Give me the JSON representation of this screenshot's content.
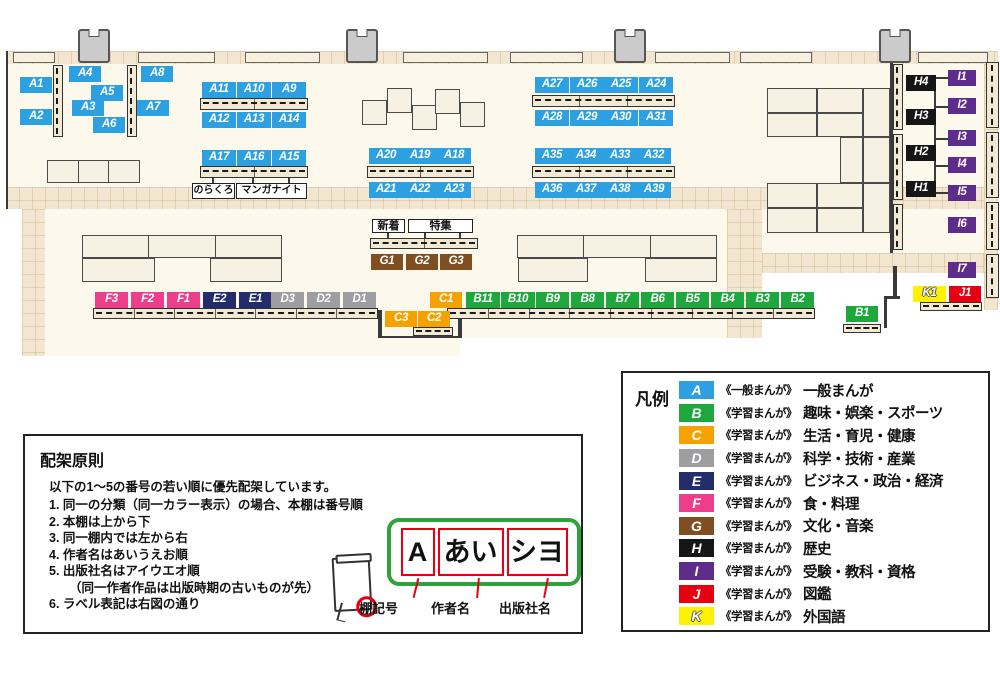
{
  "map": {
    "colors": {
      "A": "#2CA0E0",
      "B": "#1EA73C",
      "C": "#F5A200",
      "D": "#9E9EA0",
      "E": "#232D6B",
      "F": "#EE3D8B",
      "G": "#7F4F21",
      "H": "#161616",
      "I": "#5E2D8C",
      "J": "#E60012",
      "K": "#FFF100"
    },
    "floors": [
      [
        "tile",
        6,
        51,
        992,
        13
      ],
      [
        "cream",
        6,
        64,
        992,
        123
      ],
      [
        "tile",
        6,
        187,
        992,
        22
      ],
      [
        "tile",
        22,
        209,
        23,
        147
      ],
      [
        "cream",
        45,
        209,
        682,
        129
      ],
      [
        "tile",
        727,
        209,
        35,
        129
      ],
      [
        "cream",
        762,
        209,
        222,
        44
      ],
      [
        "tile",
        762,
        253,
        236,
        20
      ],
      [
        "cream",
        45,
        338,
        415,
        18
      ],
      [
        "tile",
        984,
        64,
        14,
        246
      ]
    ],
    "pillars": [
      [
        78,
        29
      ],
      [
        346,
        29
      ],
      [
        614,
        29
      ],
      [
        879,
        29
      ]
    ],
    "wall_shelves": [
      [
        13,
        42
      ],
      [
        138,
        77
      ],
      [
        245,
        75
      ],
      [
        403,
        85
      ],
      [
        510,
        73
      ],
      [
        655,
        75
      ],
      [
        740,
        72
      ],
      [
        918,
        70
      ]
    ],
    "walls": [
      [
        6,
        51,
        2,
        158
      ],
      [
        378,
        310,
        4,
        28
      ],
      [
        458,
        310,
        4,
        28
      ],
      [
        380,
        336,
        82,
        2
      ],
      [
        890,
        60,
        3,
        193
      ],
      [
        893,
        266,
        4,
        30
      ],
      [
        884,
        296,
        16,
        3
      ],
      [
        884,
        296,
        3,
        32
      ],
      [
        934,
        83,
        2,
        106
      ],
      [
        936,
        77,
        12,
        2
      ],
      [
        936,
        106,
        12,
        2
      ],
      [
        936,
        138,
        12,
        2
      ],
      [
        936,
        165,
        12,
        2
      ],
      [
        936,
        192,
        12,
        2
      ],
      [
        387,
        233,
        2,
        6
      ],
      [
        424,
        233,
        2,
        6
      ],
      [
        459,
        233,
        2,
        6
      ],
      [
        212,
        178,
        2,
        5
      ],
      [
        252,
        178,
        2,
        5
      ],
      [
        288,
        178,
        2,
        5
      ]
    ],
    "tables": [
      [
        47,
        160,
        93,
        23,
        4
      ],
      [
        362,
        100,
        25,
        25,
        1
      ],
      [
        387,
        88,
        25,
        25,
        1
      ],
      [
        412,
        105,
        25,
        25,
        1
      ],
      [
        435,
        89,
        25,
        25,
        1
      ],
      [
        460,
        102,
        25,
        25,
        1
      ],
      [
        82,
        235,
        200,
        23,
        4
      ],
      [
        82,
        258,
        73,
        24,
        1
      ],
      [
        210,
        258,
        72,
        24,
        1
      ],
      [
        517,
        235,
        200,
        23,
        4
      ],
      [
        518,
        258,
        70,
        24,
        1
      ],
      [
        645,
        258,
        72,
        24,
        1
      ],
      [
        767,
        88,
        50,
        25,
        1
      ],
      [
        817,
        88,
        46,
        25,
        1
      ],
      [
        863,
        88,
        27,
        49,
        1
      ],
      [
        767,
        113,
        50,
        24,
        1
      ],
      [
        817,
        113,
        46,
        24,
        1
      ],
      [
        840,
        137,
        23,
        46,
        1
      ],
      [
        863,
        137,
        27,
        46,
        1
      ],
      [
        767,
        183,
        50,
        25,
        1
      ],
      [
        817,
        183,
        46,
        25,
        1
      ],
      [
        863,
        183,
        27,
        50,
        1
      ],
      [
        767,
        208,
        50,
        25,
        1
      ],
      [
        817,
        208,
        46,
        25,
        1
      ]
    ],
    "shelves": [
      [
        53,
        65,
        10,
        72,
        2,
        1
      ],
      [
        127,
        65,
        10,
        72,
        2,
        1
      ],
      [
        200,
        98,
        108,
        12,
        3,
        0
      ],
      [
        200,
        166,
        108,
        12,
        3,
        0
      ],
      [
        367,
        166,
        107,
        12,
        3,
        0
      ],
      [
        532,
        95,
        143,
        12,
        4,
        0
      ],
      [
        532,
        166,
        143,
        12,
        4,
        0
      ],
      [
        370,
        238,
        108,
        11,
        3,
        0
      ],
      [
        93,
        308,
        285,
        11,
        8,
        0
      ],
      [
        447,
        308,
        368,
        11,
        10,
        0
      ],
      [
        413,
        327,
        40,
        9,
        1,
        0
      ],
      [
        843,
        324,
        38,
        9,
        1,
        0
      ],
      [
        920,
        302,
        62,
        9,
        2,
        0
      ],
      [
        986,
        62,
        13,
        66,
        2,
        1
      ],
      [
        986,
        132,
        13,
        66,
        2,
        1
      ],
      [
        986,
        202,
        13,
        48,
        1,
        1
      ],
      [
        986,
        254,
        13,
        44,
        1,
        1
      ],
      [
        893,
        64,
        10,
        66,
        2,
        1
      ],
      [
        893,
        134,
        10,
        66,
        2,
        1
      ],
      [
        893,
        204,
        10,
        46,
        1,
        1
      ]
    ],
    "signs": [
      {
        "id": "sign-norakuro",
        "text": "のらくろ",
        "x": 192,
        "y": 183,
        "w": 43,
        "h": 16,
        "fs": 10
      },
      {
        "id": "sign-manga-night",
        "text": "マンガナイト",
        "x": 236,
        "y": 183,
        "w": 71,
        "h": 16,
        "fs": 10
      },
      {
        "id": "sign-new-arrivals",
        "text": "新着",
        "x": 372,
        "y": 219,
        "w": 33,
        "h": 14,
        "fs": 11
      },
      {
        "id": "sign-special-feature",
        "text": "特集",
        "x": 408,
        "y": 219,
        "w": 65,
        "h": 14,
        "fs": 11
      }
    ],
    "labels": [
      [
        "A1",
        "A",
        20,
        77,
        32
      ],
      [
        "A2",
        "A",
        20,
        109,
        32
      ],
      [
        "A4",
        "A",
        69,
        66,
        32
      ],
      [
        "A5",
        "A",
        91,
        85,
        32
      ],
      [
        "A3",
        "A",
        72,
        100,
        32
      ],
      [
        "A6",
        "A",
        93,
        117,
        32
      ],
      [
        "A8",
        "A",
        141,
        66,
        32
      ],
      [
        "A7",
        "A",
        137,
        100,
        32
      ],
      [
        "A11",
        "A",
        202,
        82,
        34
      ],
      [
        "A10",
        "A",
        237,
        82,
        34
      ],
      [
        "A9",
        "A",
        272,
        82,
        34
      ],
      [
        "A12",
        "A",
        202,
        112,
        34
      ],
      [
        "A13",
        "A",
        237,
        112,
        34
      ],
      [
        "A14",
        "A",
        272,
        112,
        34
      ],
      [
        "A17",
        "A",
        202,
        150,
        34
      ],
      [
        "A16",
        "A",
        237,
        150,
        34
      ],
      [
        "A15",
        "A",
        272,
        150,
        34
      ],
      [
        "A27",
        "A",
        535,
        77,
        34
      ],
      [
        "A26",
        "A",
        570,
        77,
        34
      ],
      [
        "A25",
        "A",
        604,
        77,
        34
      ],
      [
        "A24",
        "A",
        639,
        77,
        34
      ],
      [
        "A28",
        "A",
        535,
        110,
        34
      ],
      [
        "A29",
        "A",
        570,
        110,
        34
      ],
      [
        "A30",
        "A",
        604,
        110,
        34
      ],
      [
        "A31",
        "A",
        639,
        110,
        34
      ],
      [
        "A20",
        "A",
        369,
        148,
        34
      ],
      [
        "A19",
        "A",
        403,
        148,
        34
      ],
      [
        "A18",
        "A",
        437,
        148,
        34
      ],
      [
        "A21",
        "A",
        369,
        182,
        34
      ],
      [
        "A22",
        "A",
        403,
        182,
        34
      ],
      [
        "A23",
        "A",
        437,
        182,
        34
      ],
      [
        "A35",
        "A",
        535,
        148,
        34
      ],
      [
        "A34",
        "A",
        569,
        148,
        34
      ],
      [
        "A33",
        "A",
        603,
        148,
        34
      ],
      [
        "A32",
        "A",
        637,
        148,
        34
      ],
      [
        "A36",
        "A",
        535,
        182,
        34
      ],
      [
        "A37",
        "A",
        569,
        182,
        34
      ],
      [
        "A38",
        "A",
        603,
        182,
        34
      ],
      [
        "A39",
        "A",
        637,
        182,
        34
      ],
      [
        "G1",
        "G",
        371,
        254,
        32
      ],
      [
        "G2",
        "G",
        406,
        254,
        32
      ],
      [
        "G3",
        "G",
        440,
        254,
        32
      ],
      [
        "F3",
        "F",
        95,
        292,
        33
      ],
      [
        "F2",
        "F",
        131,
        292,
        33
      ],
      [
        "F1",
        "F",
        167,
        292,
        33
      ],
      [
        "E2",
        "E",
        203,
        292,
        33
      ],
      [
        "E1",
        "E",
        239,
        292,
        33
      ],
      [
        "D3",
        "D",
        271,
        292,
        33
      ],
      [
        "D2",
        "D",
        307,
        292,
        33
      ],
      [
        "D1",
        "D",
        343,
        292,
        33
      ],
      [
        "C1",
        "C",
        430,
        292,
        32
      ],
      [
        "C3",
        "C",
        385,
        311,
        32
      ],
      [
        "C2",
        "C",
        418,
        311,
        32
      ],
      [
        "B11",
        "B",
        466,
        292,
        34
      ],
      [
        "B10",
        "B",
        501,
        292,
        34
      ],
      [
        "B9",
        "B",
        536,
        292,
        33
      ],
      [
        "B8",
        "B",
        571,
        292,
        33
      ],
      [
        "B7",
        "B",
        606,
        292,
        33
      ],
      [
        "B6",
        "B",
        641,
        292,
        33
      ],
      [
        "B5",
        "B",
        676,
        292,
        33
      ],
      [
        "B4",
        "B",
        711,
        292,
        33
      ],
      [
        "B3",
        "B",
        746,
        292,
        33
      ],
      [
        "B2",
        "B",
        781,
        292,
        33
      ],
      [
        "B1",
        "B",
        846,
        306,
        32
      ],
      [
        "K1",
        "K",
        913,
        286,
        33
      ],
      [
        "J1",
        "J",
        949,
        286,
        32
      ],
      [
        "H4",
        "H",
        906,
        75,
        30
      ],
      [
        "H3",
        "H",
        906,
        109,
        30
      ],
      [
        "H2",
        "H",
        906,
        145,
        30
      ],
      [
        "H1",
        "H",
        906,
        181,
        30
      ],
      [
        "I1",
        "I",
        948,
        70,
        28
      ],
      [
        "I2",
        "I",
        948,
        98,
        28
      ],
      [
        "I3",
        "I",
        948,
        130,
        28
      ],
      [
        "I4",
        "I",
        948,
        157,
        28
      ],
      [
        "I5",
        "I",
        948,
        185,
        28
      ],
      [
        "I6",
        "I",
        948,
        217,
        28
      ],
      [
        "I7",
        "I",
        948,
        262,
        28
      ]
    ]
  },
  "principles": {
    "title": "配架原則",
    "intro": "以下の1～5の番号の若い順に優先配架しています。",
    "items": [
      "同一の分類（同一カラー表示）の場合、本棚は番号順",
      "本棚は上から下",
      "同一棚内では左から右",
      "作者名はあいうえお順",
      "出版社名はアイウエオ順",
      "ラベル表記は右図の通り"
    ],
    "item5_note": "（同一作者作品は出版時期の古いものが先）",
    "label_example": {
      "shelf_code": "A",
      "author": "あい",
      "publisher": "シヨ",
      "shelf_code_label": "棚記号",
      "author_label": "作者名",
      "publisher_label": "出版社名"
    }
  },
  "legend": {
    "title": "凡例",
    "rows": [
      {
        "letter": "A",
        "series": "《一般まんが》",
        "category": "一般まんが"
      },
      {
        "letter": "B",
        "series": "《学習まんが》",
        "category": "趣味・娯楽・スポーツ"
      },
      {
        "letter": "C",
        "series": "《学習まんが》",
        "category": "生活・育児・健康"
      },
      {
        "letter": "D",
        "series": "《学習まんが》",
        "category": "科学・技術・産業"
      },
      {
        "letter": "E",
        "series": "《学習まんが》",
        "category": "ビジネス・政治・経済"
      },
      {
        "letter": "F",
        "series": "《学習まんが》",
        "category": "食・料理"
      },
      {
        "letter": "G",
        "series": "《学習まんが》",
        "category": "文化・音楽"
      },
      {
        "letter": "H",
        "series": "《学習まんが》",
        "category": "歴史"
      },
      {
        "letter": "I",
        "series": "《学習まんが》",
        "category": "受験・教科・資格"
      },
      {
        "letter": "J",
        "series": "《学習まんが》",
        "category": "図鑑"
      },
      {
        "letter": "K",
        "series": "《学習まんが》",
        "category": "外国語"
      }
    ]
  }
}
